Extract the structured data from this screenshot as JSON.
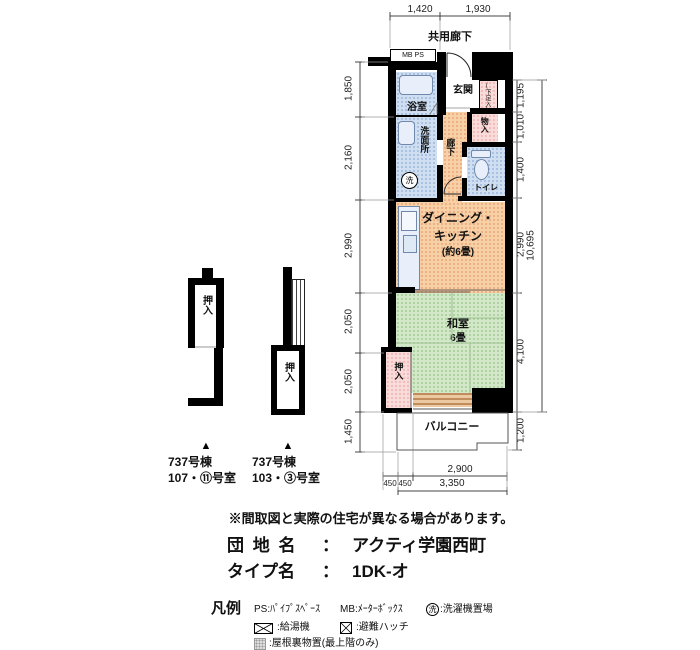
{
  "dimensions": {
    "top": [
      "1,420",
      "1,930"
    ],
    "left": [
      "1,850",
      "2,160",
      "2,990",
      "2,050",
      "2,050",
      "1,450"
    ],
    "right": [
      "1,195",
      "1,010",
      "1,400",
      "2,990",
      "4,100",
      "1,200"
    ],
    "right_total": "10,695",
    "bottom": {
      "offset1": "450",
      "offset2": "450",
      "inner": "2,900",
      "total": "3,350"
    }
  },
  "plan": {
    "corridor": "共用廊下",
    "meter_box": "MB PS",
    "rooms": {
      "bath": "浴室",
      "entrance": "玄関",
      "shoe_closet": "(下足入)",
      "washroom": "洗面所",
      "washer_symbol": "洗",
      "hallway": "廊下",
      "storage": "物入",
      "toilet": "トイレ",
      "dk_line1": "ダイニング・",
      "dk_line2": "キッチン",
      "dk_size": "(約6畳)",
      "japanese_room": "和室",
      "japanese_room_size": "6畳",
      "closet": "押入",
      "balcony": "バルコニー"
    }
  },
  "variants": [
    {
      "closet": "押入",
      "marker": "▲",
      "building": "737号棟",
      "rooms": "107・⑪号室"
    },
    {
      "closet": "押入",
      "marker": "▲",
      "building": "737号棟",
      "rooms": "103・③号室"
    }
  ],
  "info": {
    "disclaimer": "※間取図と実際の住宅が異なる場合があります。",
    "estate_label": "団 地 名",
    "estate_colon": "：",
    "estate_name": "アクティ学園西町",
    "type_label": "タイプ名",
    "type_colon": "：",
    "type_name": "1DK-オ"
  },
  "legend": {
    "title": "凡例",
    "ps": "PS:ﾊﾟｲﾌﾟｽﾍﾟｰｽ",
    "mb": "MB:ﾒｰﾀｰﾎﾞｯｸｽ",
    "washer_char": "洗",
    "washer_label": ":洗濯機置場",
    "heater_label": ":給湯機",
    "hatch_label": ":避難ハッチ",
    "attic_label": ":屋根裏物置(最上階のみ)"
  },
  "colors": {
    "wall": "#000000",
    "water_blue": "#cfdef0",
    "dk_orange": "#f7d0a6",
    "tatami_green": "#d3e7c9",
    "closet_pink": "#f9dcda",
    "window_tan": "#ecc9a0"
  }
}
